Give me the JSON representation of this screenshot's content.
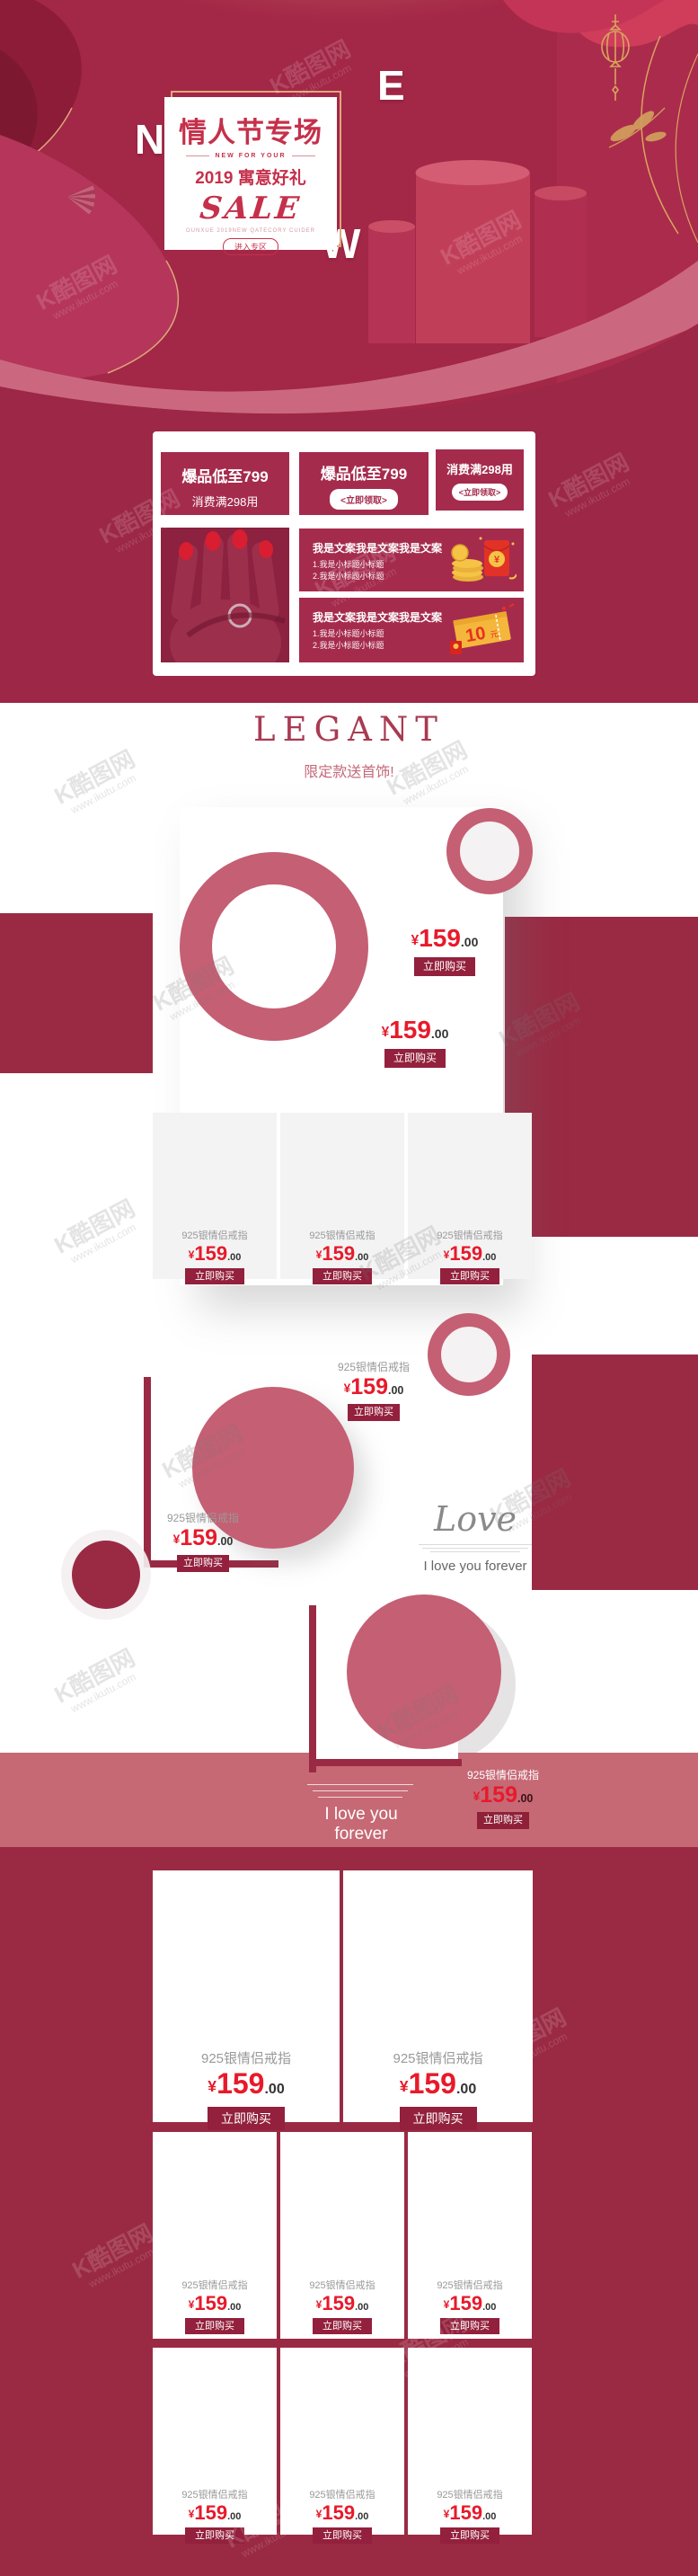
{
  "watermark": {
    "brand": "K酷图网",
    "site": "www.ikutu.com"
  },
  "hero": {
    "letters": [
      "N",
      "E",
      "W"
    ],
    "title": "情人节专场",
    "kicker": "NEW FOR YOUR",
    "line2": "2019 寓意好礼",
    "sale": "SALE",
    "tagline": "OUNXUE 2019NEW QATECORY CUIDER",
    "cta": "进入专区"
  },
  "coupons": {
    "card1_line1": "爆品低至799",
    "card1_line2": "消费满298用",
    "card2_line1": "爆品低至799",
    "card2_cta": "<立即领取>",
    "card3_line1": "消费满298用",
    "card3_cta": "<立即领取>",
    "banner1": {
      "title": "我是文案我是文案我是文案",
      "sub1": "1.我是小标题小标题",
      "sub2": "2.我是小标题小标题"
    },
    "banner2": {
      "title": "我是文案我是文案我是文案",
      "sub1": "1.我是小标题小标题",
      "sub2": "2.我是小标题小标题",
      "coupon_value": "10",
      "coupon_unit": "元"
    }
  },
  "section1": {
    "title": "LEGANT",
    "subtitle": "限定款送首饰!"
  },
  "product": {
    "name": "925银情侣戒指",
    "currency": "¥",
    "price_int": "159",
    "price_dec": ".00",
    "buy": "立即购买"
  },
  "love": {
    "script": "Love",
    "caption": "I love you forever"
  },
  "band": {
    "caption": "I love you forever"
  },
  "colors": {
    "maroon": "#9a2a44",
    "hero_red": "#a32747",
    "rose": "#c55f73",
    "band": "#c66975",
    "price_red": "#e71a2b",
    "button": "#93203c",
    "gold": "#d8a45f"
  }
}
